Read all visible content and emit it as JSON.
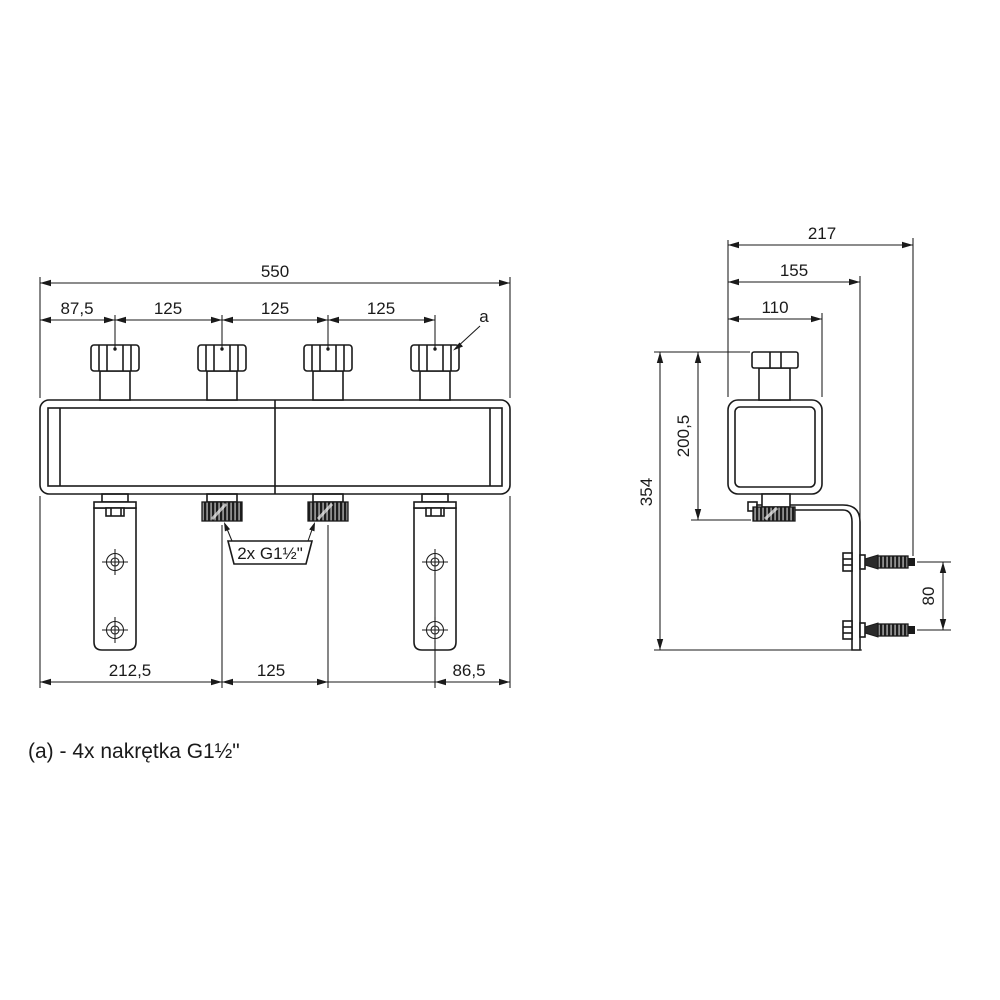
{
  "drawing": {
    "front_view": {
      "dim_overall_width": "550",
      "dim_spacing": [
        "87,5",
        "125",
        "125",
        "125"
      ],
      "leader_label": "a",
      "thread_label": "2x G1½\"",
      "dim_bottom": [
        "212,5",
        "125",
        "86,5"
      ]
    },
    "side_view": {
      "dim_depth_overall": "217",
      "dim_depth_to_bracket": "155",
      "dim_body_width": "110",
      "dim_height_overall": "354",
      "dim_height_connection": "200,5",
      "dim_anchor_spacing": "80"
    },
    "note": {
      "text": "(a) -  4x nakrętka G1½\""
    },
    "colors": {
      "line": "#1a1a1a",
      "background": "#ffffff"
    }
  }
}
